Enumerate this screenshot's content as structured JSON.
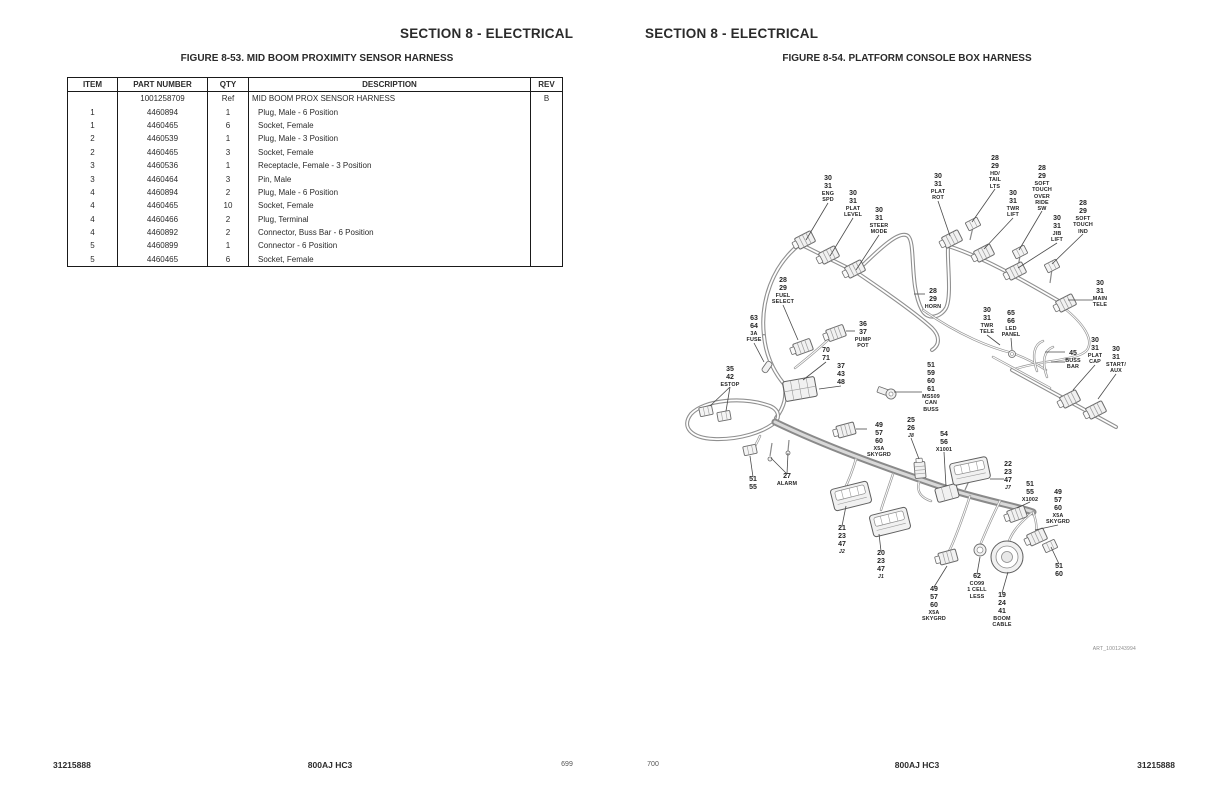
{
  "colors": {
    "ink": "#2b2b2b",
    "harness_line": "#909090",
    "paper": "#ffffff"
  },
  "left_page": {
    "section_header": "SECTION 8 - ELECTRICAL",
    "figure_caption": "FIGURE 8-53. MID BOOM PROXIMITY SENSOR HARNESS",
    "table": {
      "columns": [
        "ITEM",
        "PART NUMBER",
        "QTY",
        "DESCRIPTION",
        "REV"
      ],
      "rows": [
        [
          "",
          "1001258709",
          "Ref",
          "MID BOOM PROX SENSOR HARNESS",
          "B"
        ],
        [
          "1",
          "4460894",
          "1",
          "Plug, Male - 6 Position",
          ""
        ],
        [
          "1",
          "4460465",
          "6",
          "Socket, Female",
          ""
        ],
        [
          "2",
          "4460539",
          "1",
          "Plug, Male - 3 Position",
          ""
        ],
        [
          "2",
          "4460465",
          "3",
          "Socket, Female",
          ""
        ],
        [
          "3",
          "4460536",
          "1",
          "Receptacle, Female - 3 Position",
          ""
        ],
        [
          "3",
          "4460464",
          "3",
          "Pin, Male",
          ""
        ],
        [
          "4",
          "4460894",
          "2",
          "Plug, Male - 6 Position",
          ""
        ],
        [
          "4",
          "4460465",
          "10",
          "Socket, Female",
          ""
        ],
        [
          "4",
          "4460466",
          "2",
          "Plug, Terminal",
          ""
        ],
        [
          "4",
          "4460892",
          "2",
          "Connector, Buss Bar - 6 Position",
          ""
        ],
        [
          "5",
          "4460899",
          "1",
          "Connector - 6 Position",
          ""
        ],
        [
          "5",
          "4460465",
          "6",
          "Socket, Female",
          ""
        ]
      ]
    },
    "footer": {
      "doc_number": "31215888",
      "model": "800AJ HC3",
      "page_number": "699"
    }
  },
  "right_page": {
    "section_header": "SECTION 8 - ELECTRICAL",
    "figure_caption": "FIGURE 8-54. PLATFORM CONSOLE BOX HARNESS",
    "art_number": "ART_1001243994",
    "footer": {
      "doc_number": "31215888",
      "model": "800AJ HC3",
      "page_number": "700"
    },
    "diagram_labels": [
      {
        "id": "eng-spd",
        "lines": [
          "30",
          "31",
          "ENG",
          "SPD"
        ],
        "x": 168,
        "y": 35,
        "t": [
          146,
          100
        ]
      },
      {
        "id": "plat-level",
        "lines": [
          "30",
          "31",
          "PLAT",
          "LEVEL"
        ],
        "x": 193,
        "y": 50,
        "t": [
          170,
          116
        ]
      },
      {
        "id": "steer-mode",
        "lines": [
          "30",
          "31",
          "STEER",
          "MODE"
        ],
        "x": 219,
        "y": 67,
        "t": [
          196,
          130
        ]
      },
      {
        "id": "plat-rot",
        "lines": [
          "30",
          "31",
          "PLAT",
          "ROT"
        ],
        "x": 278,
        "y": 33,
        "t": [
          290,
          96
        ]
      },
      {
        "id": "hd-tail-lts",
        "lines": [
          "28",
          "29",
          "HD/",
          "TAIL",
          "LTS"
        ],
        "x": 335,
        "y": 15,
        "t": [
          312,
          82
        ]
      },
      {
        "id": "twr-lift",
        "lines": [
          "30",
          "31",
          "TWR",
          "LIFT"
        ],
        "x": 353,
        "y": 50,
        "t": [
          324,
          109
        ]
      },
      {
        "id": "soft-touch-override-sw",
        "lines": [
          "28",
          "29",
          "SOFT",
          "TOUCH",
          "OVER",
          "RIDE",
          "SW"
        ],
        "x": 382,
        "y": 25,
        "t": [
          359,
          110
        ]
      },
      {
        "id": "jib-lift",
        "lines": [
          "30",
          "31",
          "JIB",
          "LIFT"
        ],
        "x": 397,
        "y": 75,
        "t": [
          358,
          128
        ]
      },
      {
        "id": "soft-touch-ind",
        "lines": [
          "28",
          "29",
          "SOFT",
          "TOUCH",
          "IND"
        ],
        "x": 423,
        "y": 60,
        "t": [
          392,
          124
        ]
      },
      {
        "id": "horn",
        "lines": [
          "28",
          "29",
          "HORN"
        ],
        "x": 273,
        "y": 148,
        "t": [
          254,
          154
        ]
      },
      {
        "id": "main-tele",
        "lines": [
          "30",
          "31",
          "MAIN",
          "TELE"
        ],
        "x": 440,
        "y": 140,
        "t": [
          408,
          160
        ]
      },
      {
        "id": "fuel-select",
        "lines": [
          "28",
          "29",
          "FUEL",
          "SELECT"
        ],
        "x": 123,
        "y": 137,
        "t": [
          138,
          200
        ]
      },
      {
        "id": "fuse-3a",
        "lines": [
          "63",
          "64",
          "3A",
          "FUSE"
        ],
        "x": 94,
        "y": 175,
        "t": [
          104,
          222
        ]
      },
      {
        "id": "pump-pot",
        "lines": [
          "36",
          "37",
          "PUMP",
          "POT"
        ],
        "x": 203,
        "y": 181,
        "t": [
          186,
          191
        ]
      },
      {
        "id": "conn-70-71",
        "lines": [
          "70",
          "71"
        ],
        "x": 166,
        "y": 207,
        "t": [
          143,
          240
        ]
      },
      {
        "id": "conn-37-43-48",
        "lines": [
          "37",
          "43",
          "48"
        ],
        "x": 181,
        "y": 223,
        "t": [
          159,
          249
        ]
      },
      {
        "id": "estop",
        "lines": [
          "35",
          "42",
          "ESTOP"
        ],
        "x": 70,
        "y": 226,
        "t": [
          50,
          266
        ],
        "t2": [
          66,
          271
        ]
      },
      {
        "id": "ms509-can-buss",
        "lines": [
          "51",
          "59",
          "60",
          "61",
          "MS509",
          "CAN",
          "BUSS"
        ],
        "x": 271,
        "y": 222,
        "t": [
          234,
          252
        ]
      },
      {
        "id": "twr-tele",
        "lines": [
          "30",
          "31",
          "TWR",
          "TELE"
        ],
        "x": 327,
        "y": 167,
        "t": [
          340,
          205
        ]
      },
      {
        "id": "led-panel",
        "lines": [
          "65",
          "66",
          "LED",
          "PANEL"
        ],
        "x": 351,
        "y": 170,
        "t": [
          352,
          210
        ]
      },
      {
        "id": "x5a-skygrd-upper",
        "lines": [
          "49",
          "57",
          "60",
          "X5A",
          "SKYGRD"
        ],
        "x": 219,
        "y": 282,
        "t": [
          196,
          289
        ]
      },
      {
        "id": "j8",
        "lines": [
          "25",
          "26",
          "J8"
        ],
        "x": 251,
        "y": 277,
        "t": [
          259,
          319
        ]
      },
      {
        "id": "x1001",
        "lines": [
          "54",
          "56",
          "X1001"
        ],
        "x": 284,
        "y": 291,
        "t": [
          286,
          346
        ]
      },
      {
        "id": "buss-bar",
        "lines": [
          "45",
          "BUSS",
          "BAR"
        ],
        "x": 413,
        "y": 210,
        "t": [
          385,
          212
        ],
        "t2": [
          391,
          222
        ]
      },
      {
        "id": "plat-cap",
        "lines": [
          "30",
          "31",
          "PLAT",
          "CAP"
        ],
        "x": 435,
        "y": 197,
        "t": [
          413,
          250
        ]
      },
      {
        "id": "start-aux",
        "lines": [
          "30",
          "31",
          "START/",
          "AUX"
        ],
        "x": 456,
        "y": 206,
        "t": [
          438,
          259
        ]
      },
      {
        "id": "conn-51-55",
        "lines": [
          "51",
          "55"
        ],
        "x": 93,
        "y": 336,
        "t": [
          90,
          316
        ]
      },
      {
        "id": "alarm",
        "lines": [
          "27",
          "ALARM"
        ],
        "x": 127,
        "y": 333,
        "t": [
          111,
          318
        ],
        "t2": [
          128,
          313
        ]
      },
      {
        "id": "j2",
        "lines": [
          "21",
          "23",
          "47",
          "J2"
        ],
        "x": 182,
        "y": 385,
        "t": [
          186,
          366
        ]
      },
      {
        "id": "j1",
        "lines": [
          "20",
          "23",
          "47",
          "J1"
        ],
        "x": 221,
        "y": 410,
        "t": [
          219,
          394
        ]
      },
      {
        "id": "x5a-skygrd-lower",
        "lines": [
          "49",
          "57",
          "60",
          "X5A",
          "SKYGRD"
        ],
        "x": 274,
        "y": 446,
        "t": [
          287,
          426
        ]
      },
      {
        "id": "j7",
        "lines": [
          "22",
          "23",
          "47",
          "J7"
        ],
        "x": 348,
        "y": 321,
        "t": [
          330,
          339
        ]
      },
      {
        "id": "x1002",
        "lines": [
          "51",
          "55",
          "X1002"
        ],
        "x": 370,
        "y": 341,
        "t": [
          357,
          368
        ]
      },
      {
        "id": "x5a-skygrd-right",
        "lines": [
          "49",
          "57",
          "60",
          "X5A",
          "SKYGRD"
        ],
        "x": 398,
        "y": 349,
        "t": [
          375,
          390
        ]
      },
      {
        "id": "conn-51-60",
        "lines": [
          "51",
          "60"
        ],
        "x": 399,
        "y": 423,
        "t": [
          391,
          407
        ]
      },
      {
        "id": "co99-1cell-less",
        "lines": [
          "62",
          "CO99",
          "1 CELL",
          "LESS"
        ],
        "x": 317,
        "y": 433,
        "t": [
          320,
          417
        ]
      },
      {
        "id": "boom-cable",
        "lines": [
          "19",
          "24",
          "41",
          "BOOM",
          "CABLE"
        ],
        "x": 342,
        "y": 452,
        "t": [
          348,
          432
        ]
      }
    ]
  }
}
